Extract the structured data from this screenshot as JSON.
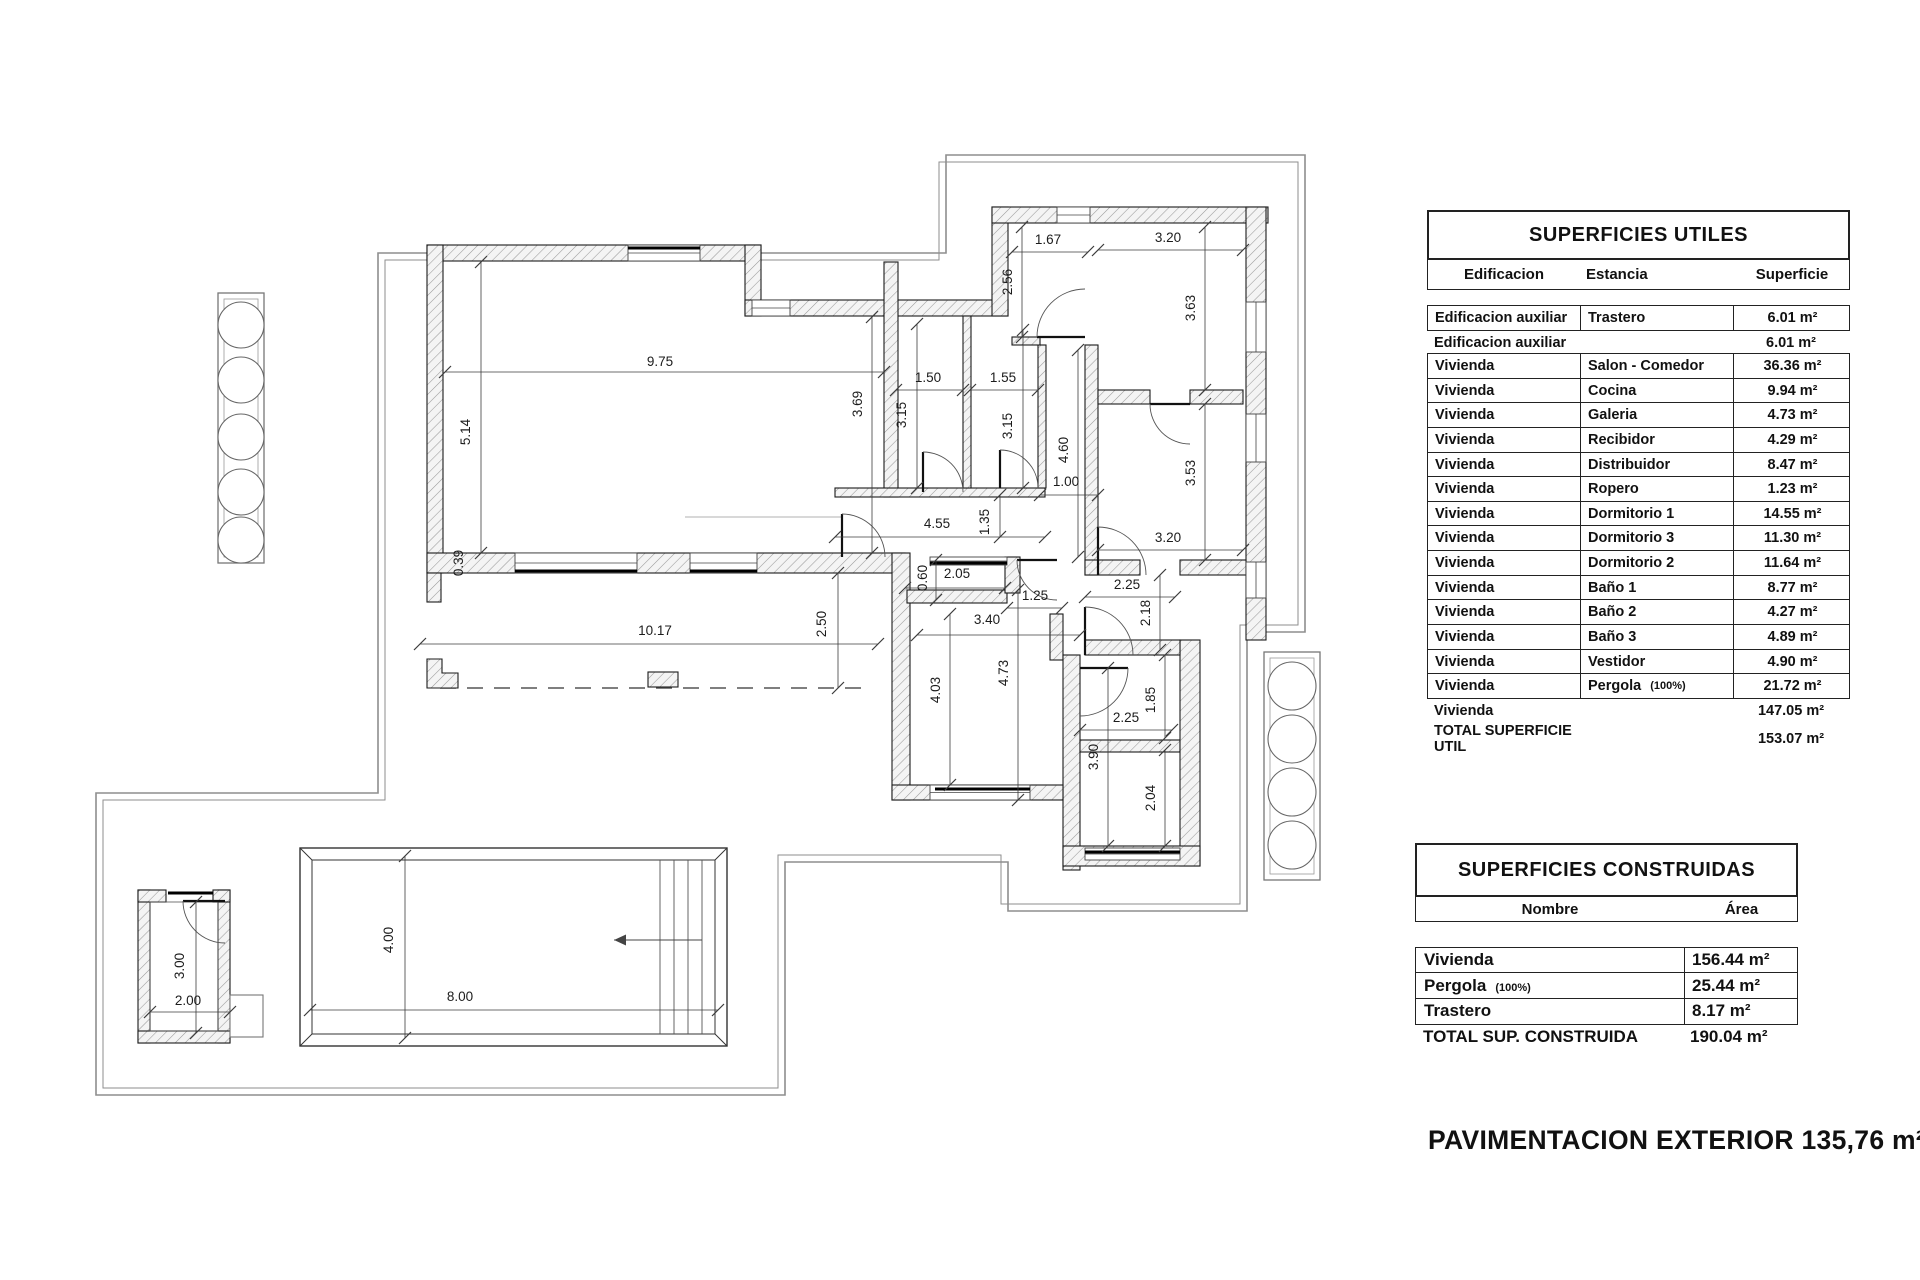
{
  "page": {
    "background": "#ffffff",
    "line_color": "#1b1b1b",
    "boundary_color": "#8e8e8e"
  },
  "floor_plan": {
    "name": "housing floor plan with pool",
    "trees_left_count": 5,
    "trees_right_count": 4,
    "dimensions": [
      {
        "v": "9.75",
        "x": 660,
        "y": 366,
        "rot": 0
      },
      {
        "v": "5.14",
        "x": 470,
        "y": 432,
        "rot": 1
      },
      {
        "v": "0.39",
        "x": 463,
        "y": 563,
        "rot": 1
      },
      {
        "v": "3.69",
        "x": 862,
        "y": 404,
        "rot": 1
      },
      {
        "v": "1.50",
        "x": 928,
        "y": 382,
        "rot": 0
      },
      {
        "v": "3.15",
        "x": 906,
        "y": 415,
        "rot": 1
      },
      {
        "v": "1.55",
        "x": 1003,
        "y": 382,
        "rot": 0
      },
      {
        "v": "3.15",
        "x": 1012,
        "y": 426,
        "rot": 1
      },
      {
        "v": "1.67",
        "x": 1048,
        "y": 244,
        "rot": 0
      },
      {
        "v": "2.56",
        "x": 1012,
        "y": 282,
        "rot": 1
      },
      {
        "v": "3.20",
        "x": 1168,
        "y": 242,
        "rot": 0
      },
      {
        "v": "3.63",
        "x": 1195,
        "y": 308,
        "rot": 1
      },
      {
        "v": "4.60",
        "x": 1068,
        "y": 450,
        "rot": 1
      },
      {
        "v": "1.00",
        "x": 1066,
        "y": 486,
        "rot": 0
      },
      {
        "v": "3.53",
        "x": 1195,
        "y": 473,
        "rot": 1
      },
      {
        "v": "3.20",
        "x": 1168,
        "y": 542,
        "rot": 0
      },
      {
        "v": "1.35",
        "x": 989,
        "y": 522,
        "rot": 1
      },
      {
        "v": "4.55",
        "x": 937,
        "y": 528,
        "rot": 0
      },
      {
        "v": "2.05",
        "x": 957,
        "y": 578,
        "rot": 0
      },
      {
        "v": "0.60",
        "x": 927,
        "y": 578,
        "rot": 1
      },
      {
        "v": "1.25",
        "x": 1035,
        "y": 600,
        "rot": 0
      },
      {
        "v": "2.25",
        "x": 1127,
        "y": 589,
        "rot": 0
      },
      {
        "v": "2.18",
        "x": 1150,
        "y": 613,
        "rot": 1
      },
      {
        "v": "3.40",
        "x": 987,
        "y": 624,
        "rot": 0
      },
      {
        "v": "2.50",
        "x": 826,
        "y": 624,
        "rot": 1
      },
      {
        "v": "10.17",
        "x": 655,
        "y": 635,
        "rot": 0
      },
      {
        "v": "4.03",
        "x": 940,
        "y": 690,
        "rot": 1
      },
      {
        "v": "4.73",
        "x": 1008,
        "y": 673,
        "rot": 1
      },
      {
        "v": "2.25",
        "x": 1126,
        "y": 722,
        "rot": 0
      },
      {
        "v": "1.85",
        "x": 1155,
        "y": 700,
        "rot": 1
      },
      {
        "v": "3.90",
        "x": 1098,
        "y": 757,
        "rot": 1
      },
      {
        "v": "2.04",
        "x": 1155,
        "y": 798,
        "rot": 1
      },
      {
        "v": "4.00",
        "x": 393,
        "y": 940,
        "rot": 1
      },
      {
        "v": "8.00",
        "x": 460,
        "y": 1001,
        "rot": 0
      },
      {
        "v": "3.00",
        "x": 184,
        "y": 966,
        "rot": 1
      },
      {
        "v": "2.00",
        "x": 188,
        "y": 1005,
        "rot": 0
      }
    ]
  },
  "tables": {
    "utiles": {
      "title": "SUPERFICIES UTILES",
      "columns": [
        "Edificacion",
        "Estancia",
        "Superficie"
      ],
      "rows": [
        {
          "edificacion": "Edificacion auxiliar",
          "estancia": "Trastero",
          "note": "",
          "superficie": "6.01 m²",
          "style": "boxed"
        },
        {
          "edificacion": "Edificacion auxiliar",
          "estancia": "",
          "note": "",
          "superficie": "6.01 m²",
          "style": "plain"
        },
        {
          "edificacion": "Vivienda",
          "estancia": "Salon - Comedor",
          "note": "",
          "superficie": "36.36 m²",
          "style": "boxed"
        },
        {
          "edificacion": "Vivienda",
          "estancia": "Cocina",
          "note": "",
          "superficie": "9.94 m²",
          "style": "boxed"
        },
        {
          "edificacion": "Vivienda",
          "estancia": "Galeria",
          "note": "",
          "superficie": "4.73 m²",
          "style": "boxed"
        },
        {
          "edificacion": "Vivienda",
          "estancia": "Recibidor",
          "note": "",
          "superficie": "4.29 m²",
          "style": "boxed"
        },
        {
          "edificacion": "Vivienda",
          "estancia": "Distribuidor",
          "note": "",
          "superficie": "8.47 m²",
          "style": "boxed"
        },
        {
          "edificacion": "Vivienda",
          "estancia": "Ropero",
          "note": "",
          "superficie": "1.23 m²",
          "style": "boxed"
        },
        {
          "edificacion": "Vivienda",
          "estancia": "Dormitorio 1",
          "note": "",
          "superficie": "14.55 m²",
          "style": "boxed"
        },
        {
          "edificacion": "Vivienda",
          "estancia": "Dormitorio 3",
          "note": "",
          "superficie": "11.30 m²",
          "style": "boxed"
        },
        {
          "edificacion": "Vivienda",
          "estancia": "Dormitorio 2",
          "note": "",
          "superficie": "11.64 m²",
          "style": "boxed"
        },
        {
          "edificacion": "Vivienda",
          "estancia": "Baño 1",
          "note": "",
          "superficie": "8.77 m²",
          "style": "boxed"
        },
        {
          "edificacion": "Vivienda",
          "estancia": "Baño 2",
          "note": "",
          "superficie": "4.27 m²",
          "style": "boxed"
        },
        {
          "edificacion": "Vivienda",
          "estancia": "Baño 3",
          "note": "",
          "superficie": "4.89 m²",
          "style": "boxed"
        },
        {
          "edificacion": "Vivienda",
          "estancia": "Vestidor",
          "note": "",
          "superficie": "4.90 m²",
          "style": "boxed"
        },
        {
          "edificacion": "Vivienda",
          "estancia": "Pergola",
          "note": "(100%)",
          "superficie": "21.72 m²",
          "style": "boxed"
        },
        {
          "edificacion": "Vivienda",
          "estancia": "",
          "note": "",
          "superficie": "147.05 m²",
          "style": "plain"
        },
        {
          "edificacion": "TOTAL SUPERFICIE UTIL",
          "estancia": "",
          "note": "",
          "superficie": "153.07 m²",
          "style": "plain"
        }
      ]
    },
    "construidas": {
      "title": "SUPERFICIES CONSTRUIDAS",
      "columns": [
        "Nombre",
        "Área"
      ],
      "rows": [
        {
          "nombre": "Vivienda",
          "note": "",
          "area": "156.44 m²",
          "style": "boxed"
        },
        {
          "nombre": "Pergola",
          "note": "(100%)",
          "area": "25.44 m²",
          "style": "boxed"
        },
        {
          "nombre": "Trastero",
          "note": "",
          "area": "8.17 m²",
          "style": "boxed"
        },
        {
          "nombre": "TOTAL SUP. CONSTRUIDA",
          "note": "",
          "area": "190.04 m²",
          "style": "plain"
        }
      ]
    }
  },
  "footer": {
    "text": "PAVIMENTACION EXTERIOR 135,76 m²"
  }
}
